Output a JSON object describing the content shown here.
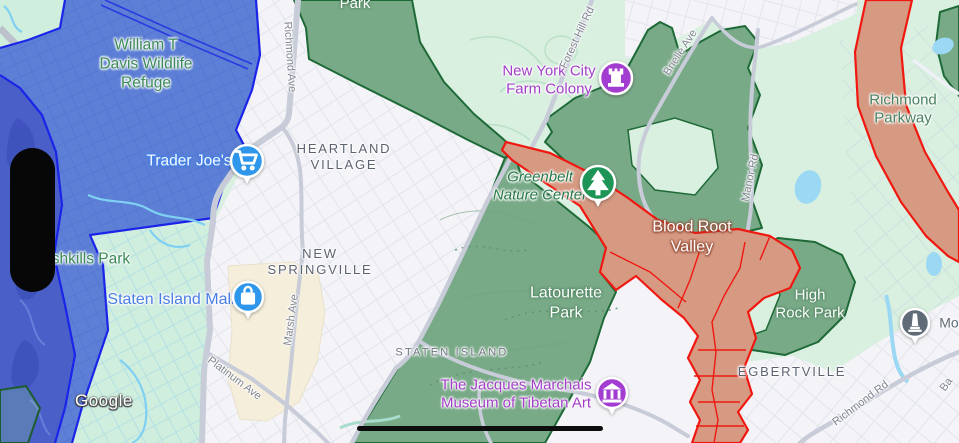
{
  "colors": {
    "base_green": "#d9f0e0",
    "park_green_fill": "#79aa88",
    "park_green_border": "#1e6a37",
    "overlay_blue_fill": "#5d80d6",
    "overlay_blue_deep": "#4b5fc8",
    "overlay_blue_border": "#1b24e8",
    "corridor_fill": "#d69a83",
    "corridor_border": "#f01810",
    "urban_fill": "#f4f3f7",
    "mall_fill": "#f5eedb",
    "water": "#9bd8f3",
    "poi_blue": "#2e97ec",
    "poi_purple": "#a33dd1",
    "poi_green": "#1d9556",
    "poi_gray": "#5f6c78"
  },
  "attribution": {
    "text": "Google"
  },
  "map": {
    "labels": [
      {
        "id": "william-t-davis-wildlife-refuge",
        "text": "William T\nDavis Wildlife\nRefuge",
        "x": 146,
        "y": 65,
        "kind": "park-green halo-w",
        "rot": 0,
        "interactable": false
      },
      {
        "id": "richmond-ave-north",
        "text": "Richmond Ave",
        "x": 289,
        "y": 57,
        "kind": "road halo-w",
        "rot": 86,
        "interactable": false
      },
      {
        "id": "park-top",
        "text": "Park",
        "x": 355,
        "y": 4,
        "kind": "park-white",
        "rot": 0,
        "interactable": false
      },
      {
        "id": "new-york-city-farm-colony",
        "text": "New York City\nFarm Colony",
        "x": 549,
        "y": 81,
        "kind": "poi-purple halo-w",
        "rot": 0,
        "interactable": true
      },
      {
        "id": "forest-hill-rd-north",
        "text": "Forest Hill Rd",
        "x": 578,
        "y": 38,
        "kind": "road halo-w",
        "rot": -65,
        "interactable": false
      },
      {
        "id": "brielle-ave",
        "text": "Brielle Ave",
        "x": 681,
        "y": 53,
        "kind": "road halo-w",
        "rot": -57,
        "interactable": false
      },
      {
        "id": "richmond-parkway",
        "text": "Richmond\nParkway",
        "x": 903,
        "y": 110,
        "kind": "park-green2 halo-w",
        "rot": 0,
        "interactable": false
      },
      {
        "id": "trader-joes",
        "text": "Trader Joe's",
        "x": 189,
        "y": 162,
        "kind": "poi-white-blue",
        "rot": 0,
        "interactable": true
      },
      {
        "id": "heartland-village",
        "text": "HEARTLAND\nVILLAGE",
        "x": 344,
        "y": 157,
        "kind": "nbhd halo-w",
        "rot": 0,
        "interactable": false
      },
      {
        "id": "greenbelt-nature-center",
        "text": "Greenbelt\nNature Center",
        "x": 540,
        "y": 187,
        "kind": "reserve-italic halo-w",
        "rot": 0,
        "interactable": true
      },
      {
        "id": "blood-root-valley",
        "text": "Blood Root\nValley",
        "x": 692,
        "y": 237,
        "kind": "overlay-white-red",
        "rot": 0,
        "interactable": false
      },
      {
        "id": "manor-rd",
        "text": "Manor Rd",
        "x": 751,
        "y": 178,
        "kind": "road halo-w",
        "rot": -78,
        "interactable": false
      },
      {
        "id": "high-rock-park",
        "text": "High\nRock Park",
        "x": 810,
        "y": 305,
        "kind": "park-white",
        "rot": 0,
        "interactable": false
      },
      {
        "id": "shkills-park",
        "text": "shkills Park",
        "x": 91,
        "y": 260,
        "kind": "park-green halo-w",
        "rot": 0,
        "interactable": false
      },
      {
        "id": "new-springville",
        "text": "NEW\nSPRINGVILLE",
        "x": 320,
        "y": 262,
        "kind": "nbhd halo-w",
        "rot": 0,
        "interactable": false
      },
      {
        "id": "staten-island-mall",
        "text": "Staten Island Mall",
        "x": 171,
        "y": 300,
        "kind": "poi-blue halo-w",
        "rot": 0,
        "interactable": true
      },
      {
        "id": "marsh-ave",
        "text": "Marsh Ave",
        "x": 292,
        "y": 320,
        "kind": "road halo-w",
        "rot": -82,
        "interactable": false
      },
      {
        "id": "latourette-park",
        "text": "Latourette\nPark",
        "x": 566,
        "y": 303,
        "kind": "park-white-lg",
        "rot": 0,
        "interactable": false
      },
      {
        "id": "platinum-ave",
        "text": "Platinum Ave",
        "x": 234,
        "y": 379,
        "kind": "road halo-w",
        "rot": 37,
        "interactable": false
      },
      {
        "id": "staten-island",
        "text": "STATEN ISLAND",
        "x": 452,
        "y": 353,
        "kind": "nbhd-sm halo-w",
        "rot": 0,
        "interactable": false
      },
      {
        "id": "jacques-marchais-museum",
        "text": "The Jacques Marchais\nMuseum of Tibetan Art",
        "x": 516,
        "y": 395,
        "kind": "poi-purple halo-w",
        "rot": 0,
        "interactable": true
      },
      {
        "id": "egbertville",
        "text": "EGBERTVILLE",
        "x": 792,
        "y": 372,
        "kind": "nbhd halo-w",
        "rot": 0,
        "interactable": false
      },
      {
        "id": "richmond-rd-southeast",
        "text": "Richmond Rd",
        "x": 861,
        "y": 404,
        "kind": "road halo-w",
        "rot": -37,
        "interactable": false
      },
      {
        "id": "moravian-label",
        "text": "Mo",
        "x": 949,
        "y": 323,
        "kind": "cemetery halo-w",
        "rot": 0,
        "interactable": true
      },
      {
        "id": "ba-road",
        "text": "Ba",
        "x": 947,
        "y": 385,
        "kind": "road halo-w",
        "rot": -55,
        "interactable": false
      }
    ],
    "pois": [
      {
        "id": "trader-joes-pin",
        "icon": "cart-icon",
        "x": 247,
        "y": 161,
        "color": "#2e97ec",
        "r": 16,
        "pointer": true
      },
      {
        "id": "farm-colony-pin",
        "icon": "castle-icon",
        "x": 616,
        "y": 78,
        "color": "#a33dd1",
        "r": 16,
        "pointer": false
      },
      {
        "id": "greenbelt-pin",
        "icon": "tree-icon",
        "x": 598,
        "y": 183,
        "color": "#1d9556",
        "r": 17,
        "pointer": true
      },
      {
        "id": "mall-pin",
        "icon": "bag-icon",
        "x": 248,
        "y": 297,
        "color": "#2e97ec",
        "r": 15,
        "pointer": true
      },
      {
        "id": "museum-pin",
        "icon": "museum-icon",
        "x": 612,
        "y": 393,
        "color": "#a33dd1",
        "r": 15,
        "pointer": true
      },
      {
        "id": "moravian-pin",
        "icon": "obelisk-icon",
        "x": 915,
        "y": 323,
        "color": "#5f6c78",
        "r": 14,
        "pointer": true
      }
    ]
  }
}
